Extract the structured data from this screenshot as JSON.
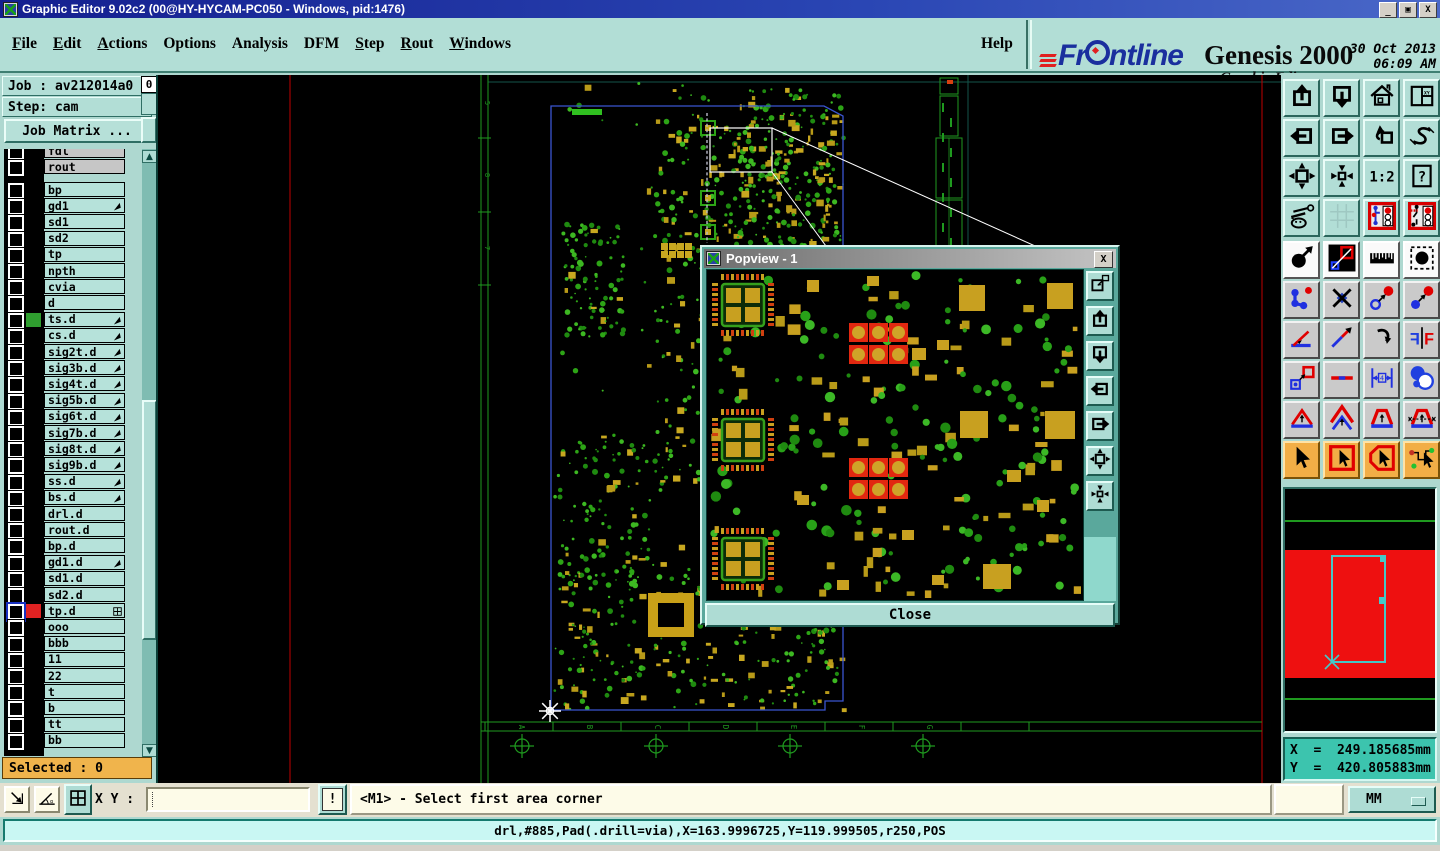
{
  "window": {
    "title": "Graphic Editor 9.02c2 (00@HY-HYCAM-PC050 - Windows, pid:1476)",
    "minimize": "_",
    "restore": "o",
    "close": "X"
  },
  "menu": {
    "items": [
      {
        "label": "File",
        "u": 0
      },
      {
        "label": "Edit",
        "u": 0
      },
      {
        "label": "Actions",
        "u": 0
      },
      {
        "label": "Options",
        "u": -1
      },
      {
        "label": "Analysis",
        "u": -1
      },
      {
        "label": "DFM",
        "u": -1
      },
      {
        "label": "Step",
        "u": 0
      },
      {
        "label": "Rout",
        "u": 0
      },
      {
        "label": "Windows",
        "u": 0
      }
    ],
    "help": "Help"
  },
  "brand": {
    "name": "Frontline",
    "product": "Genesis 2000",
    "edition": "Graphic Editor",
    "date": "30 Oct 2013",
    "time": "06:09 AM"
  },
  "job": {
    "job_line": "Job : av212014a0",
    "step_line": "Step: cam",
    "matrix_button": "Job Matrix ...",
    "selected": "Selected : 0",
    "counter": "0"
  },
  "layers": {
    "top_group": [
      {
        "name": "fdl",
        "partial": true
      },
      {
        "name": "rout",
        "partial": false
      }
    ],
    "rows": [
      {
        "name": "bp"
      },
      {
        "name": "gd1",
        "arrow": true
      },
      {
        "name": "sd1"
      },
      {
        "name": "sd2"
      },
      {
        "name": "tp"
      },
      {
        "name": "npth"
      },
      {
        "name": "cvia"
      },
      {
        "name": "d"
      },
      {
        "name": "ts.d",
        "arrow": true,
        "swatch": "#2f9e2f"
      },
      {
        "name": "cs.d",
        "arrow": true
      },
      {
        "name": "sig2t.d",
        "arrow": true
      },
      {
        "name": "sig3b.d",
        "arrow": true
      },
      {
        "name": "sig4t.d",
        "arrow": true
      },
      {
        "name": "sig5b.d",
        "arrow": true
      },
      {
        "name": "sig6t.d",
        "arrow": true
      },
      {
        "name": "sig7b.d",
        "arrow": true
      },
      {
        "name": "sig8t.d",
        "arrow": true
      },
      {
        "name": "sig9b.d",
        "arrow": true
      },
      {
        "name": "ss.d",
        "arrow": true
      },
      {
        "name": "bs.d",
        "arrow": true
      },
      {
        "name": "drl.d"
      },
      {
        "name": "rout.d"
      },
      {
        "name": "bp.d"
      },
      {
        "name": "gd1.d",
        "arrow": true
      },
      {
        "name": "sd1.d"
      },
      {
        "name": "sd2.d"
      },
      {
        "name": "tp.d",
        "swatch": "#e02222",
        "selected": true,
        "plus": true
      },
      {
        "name": "ooo"
      },
      {
        "name": "bbb"
      },
      {
        "name": "11"
      },
      {
        "name": "22"
      },
      {
        "name": "t"
      },
      {
        "name": "b"
      },
      {
        "name": "tt"
      },
      {
        "name": "bb"
      }
    ]
  },
  "toolbar": {
    "buttons": [
      {
        "name": "zoom-in",
        "icon": "boxUp",
        "grp": "t"
      },
      {
        "name": "zoom-out",
        "icon": "boxDown",
        "grp": "t"
      },
      {
        "name": "home-view",
        "icon": "home",
        "grp": "t"
      },
      {
        "name": "split-views-xy",
        "icon": "splitXY",
        "grp": "t"
      },
      {
        "name": "pan-left",
        "icon": "boxLeft",
        "grp": "t"
      },
      {
        "name": "pan-right",
        "icon": "boxRight",
        "grp": "t"
      },
      {
        "name": "previous-view",
        "icon": "undoView",
        "grp": "t"
      },
      {
        "name": "serpentine-view",
        "icon": "sShape",
        "grp": "t"
      },
      {
        "name": "fit-window",
        "icon": "fit",
        "grp": "t"
      },
      {
        "name": "center-view",
        "icon": "center",
        "grp": "t"
      },
      {
        "name": "scale-1-2",
        "icon": "scale12",
        "grp": "t"
      },
      {
        "name": "help-context",
        "icon": "help",
        "grp": "t"
      },
      {
        "name": "setup-tools",
        "icon": "tools",
        "grp": "t"
      },
      {
        "name": "grid-setup",
        "icon": "grid",
        "grp": "t"
      },
      {
        "name": "display-profile-1",
        "icon": "profile1",
        "grp": "t"
      },
      {
        "name": "display-profile-2",
        "icon": "profile2",
        "grp": "t"
      },
      {
        "name": "move-feature",
        "icon": "moveCircle",
        "grp": "w"
      },
      {
        "name": "reshape-feature",
        "icon": "reshape",
        "grp": "w"
      },
      {
        "name": "measure-ruler",
        "icon": "ruler",
        "grp": "w"
      },
      {
        "name": "select-pad",
        "icon": "padSelect",
        "grp": "w"
      },
      {
        "name": "select-chain",
        "icon": "chain",
        "grp": "g"
      },
      {
        "name": "unselect-x",
        "icon": "unselectX",
        "grp": "g"
      },
      {
        "name": "copy-to-layer",
        "icon": "copyPad",
        "grp": "g"
      },
      {
        "name": "move-to-layer",
        "icon": "movePad",
        "grp": "g"
      },
      {
        "name": "measure-angle",
        "icon": "angleTool",
        "grp": "g"
      },
      {
        "name": "draw-line",
        "icon": "lineTool",
        "grp": "g"
      },
      {
        "name": "rotate-feature",
        "icon": "rotateTool",
        "grp": "g"
      },
      {
        "name": "mirror-feature",
        "icon": "mirrorFF",
        "grp": "g"
      },
      {
        "name": "resize-feature",
        "icon": "resizeBox",
        "grp": "g"
      },
      {
        "name": "break-segment",
        "icon": "segment",
        "grp": "g"
      },
      {
        "name": "change-width",
        "icon": "widthGauge",
        "grp": "g"
      },
      {
        "name": "touching-features",
        "icon": "touchShapes",
        "grp": "g"
      },
      {
        "name": "contour-fill-1",
        "icon": "tri1",
        "grp": "g"
      },
      {
        "name": "contour-fill-2",
        "icon": "tri2",
        "grp": "g"
      },
      {
        "name": "contour-fill-3",
        "icon": "tri3",
        "grp": "g"
      },
      {
        "name": "contour-fill-4",
        "icon": "tri4",
        "grp": "g"
      },
      {
        "name": "select-mode-single",
        "icon": "cursor",
        "grp": "o"
      },
      {
        "name": "select-mode-box",
        "icon": "cursorBox",
        "grp": "o"
      },
      {
        "name": "select-mode-contour",
        "icon": "cursorPoly",
        "grp": "o"
      },
      {
        "name": "select-mode-net",
        "icon": "cursorNet",
        "grp": "o"
      }
    ]
  },
  "popview": {
    "title": "Popview - 1",
    "close": "Close",
    "close_x": "X",
    "buttons": [
      {
        "name": "popout-view",
        "icon": "popOut"
      },
      {
        "name": "pop-zoom-in",
        "icon": "boxUp"
      },
      {
        "name": "pop-zoom-out",
        "icon": "boxDown"
      },
      {
        "name": "pop-pan-left",
        "icon": "boxLeft"
      },
      {
        "name": "pop-pan-right",
        "icon": "boxRight"
      },
      {
        "name": "pop-fit-window",
        "icon": "fit"
      },
      {
        "name": "pop-center-view",
        "icon": "center"
      }
    ]
  },
  "controls": {
    "xy_label": "X Y :",
    "xy_value": "",
    "bang": "!",
    "prompt": "<M1> - Select first area corner",
    "units": "MM",
    "bottom_buttons": [
      {
        "name": "resize-pointer",
        "icon": "diagArrow",
        "active": false
      },
      {
        "name": "snap-angle",
        "icon": "angleSnap",
        "active": false
      },
      {
        "name": "pane-grid",
        "icon": "pane",
        "active": true
      }
    ]
  },
  "coords": {
    "x": "X  =  249.185685mm",
    "y": "Y  =  420.805883mm"
  },
  "status_message": "drl,#885,Pad(.drill=via),X=163.9996725,Y=119.999505,r250,POS",
  "canvas_art": {
    "frame_letters": [
      "A",
      "B",
      "C",
      "D",
      "E",
      "F",
      "G"
    ],
    "row_refs": [
      "5",
      "8",
      "7"
    ],
    "board_outline": [
      [
        393,
        31
      ],
      [
        666,
        31
      ],
      [
        685,
        41
      ],
      [
        685,
        626
      ],
      [
        667,
        626
      ],
      [
        667,
        635
      ],
      [
        393,
        635
      ]
    ],
    "zoom_box": [
      552,
      53,
      62,
      44
    ],
    "connectors": [
      [
        614,
        53,
        924,
        192
      ],
      [
        614,
        97,
        924,
        522
      ]
    ],
    "crosses_x": [
      364,
      498,
      632,
      765
    ],
    "crosses_y": 671,
    "red_line_x": [
      132,
      1104
    ],
    "colors": {
      "board_green": "#2da416",
      "pad_yellow": "#c4a01c",
      "outline_blue": "#3a55d0",
      "frame_green": "#1f9a1f",
      "red_line": "#c00000",
      "highlight": "#30c020",
      "pad_red": "#e22810",
      "teal_guide": "#14544a"
    }
  },
  "navigator": {
    "band_color": "#ee1010",
    "line_color": "#1f9a1f",
    "view_rect_color": "#45c8c8"
  }
}
